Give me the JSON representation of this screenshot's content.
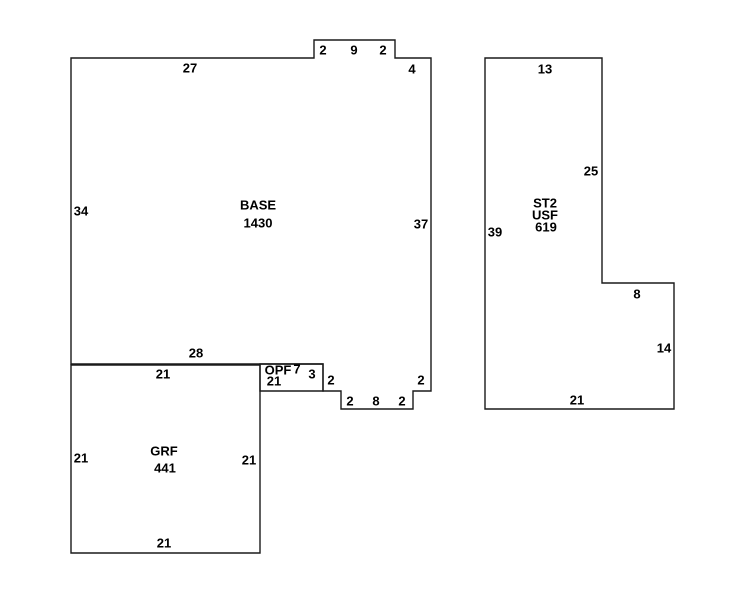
{
  "sketch": {
    "background_color": "#ffffff",
    "line_color": "#1a1a1a",
    "text_color": "#000000",
    "shapes": [
      {
        "name": "base",
        "type_label": "BASE",
        "area_label": "1430",
        "points": [
          [
            71,
            58
          ],
          [
            314,
            58
          ],
          [
            314,
            40
          ],
          [
            395,
            40
          ],
          [
            395,
            58
          ],
          [
            431,
            58
          ],
          [
            431,
            391
          ],
          [
            413,
            391
          ],
          [
            413,
            409
          ],
          [
            341,
            409
          ],
          [
            341,
            391
          ],
          [
            323,
            391
          ],
          [
            323,
            364
          ],
          [
            71,
            364
          ]
        ]
      },
      {
        "name": "opf",
        "type_label": "OPF",
        "area_label": "21",
        "points": [
          [
            260,
            364
          ],
          [
            323,
            364
          ],
          [
            323,
            391
          ],
          [
            260,
            391
          ]
        ]
      },
      {
        "name": "grf",
        "type_label": "GRF",
        "area_label": "441",
        "points": [
          [
            71,
            365
          ],
          [
            260,
            365
          ],
          [
            260,
            553
          ],
          [
            71,
            553
          ]
        ]
      },
      {
        "name": "st2",
        "type_label": "ST2",
        "sub_label": "USF",
        "area_label": "619",
        "points": [
          [
            485,
            58
          ],
          [
            602,
            58
          ],
          [
            602,
            283
          ],
          [
            674,
            283
          ],
          [
            674,
            409
          ],
          [
            485,
            409
          ]
        ]
      }
    ],
    "texts": [
      {
        "t": "27",
        "x": 190,
        "y": 68,
        "kind": "dim",
        "shape": "base"
      },
      {
        "t": "2",
        "x": 323,
        "y": 50,
        "kind": "dim",
        "shape": "base"
      },
      {
        "t": "9",
        "x": 354,
        "y": 50,
        "kind": "dim",
        "shape": "base"
      },
      {
        "t": "2",
        "x": 383,
        "y": 50,
        "kind": "dim",
        "shape": "base"
      },
      {
        "t": "4",
        "x": 412,
        "y": 69,
        "kind": "dim",
        "shape": "base"
      },
      {
        "t": "34",
        "x": 81,
        "y": 211,
        "kind": "dim",
        "shape": "base"
      },
      {
        "t": "BASE",
        "x": 258,
        "y": 205,
        "kind": "type",
        "shape": "base"
      },
      {
        "t": "1430",
        "x": 258,
        "y": 223,
        "kind": "area",
        "shape": "base"
      },
      {
        "t": "37",
        "x": 421,
        "y": 224,
        "kind": "dim",
        "shape": "base"
      },
      {
        "t": "28",
        "x": 196,
        "y": 353,
        "kind": "dim",
        "shape": "base"
      },
      {
        "t": "2",
        "x": 421,
        "y": 380,
        "kind": "dim",
        "shape": "base"
      },
      {
        "t": "2",
        "x": 402,
        "y": 401,
        "kind": "dim",
        "shape": "base"
      },
      {
        "t": "8",
        "x": 376,
        "y": 401,
        "kind": "dim",
        "shape": "base"
      },
      {
        "t": "2",
        "x": 350,
        "y": 401,
        "kind": "dim",
        "shape": "base"
      },
      {
        "t": "2",
        "x": 331,
        "y": 380,
        "kind": "dim",
        "shape": "base"
      },
      {
        "t": "OPF",
        "x": 278,
        "y": 370,
        "kind": "type",
        "shape": "opf"
      },
      {
        "t": "7",
        "x": 297,
        "y": 369,
        "kind": "dim",
        "shape": "opf"
      },
      {
        "t": "21",
        "x": 274,
        "y": 381,
        "kind": "area",
        "shape": "opf"
      },
      {
        "t": "3",
        "x": 312,
        "y": 374,
        "kind": "dim",
        "shape": "opf"
      },
      {
        "t": "21",
        "x": 163,
        "y": 374,
        "kind": "dim",
        "shape": "grf"
      },
      {
        "t": "21",
        "x": 81,
        "y": 458,
        "kind": "dim",
        "shape": "grf"
      },
      {
        "t": "GRF",
        "x": 164,
        "y": 451,
        "kind": "type",
        "shape": "grf"
      },
      {
        "t": "441",
        "x": 165,
        "y": 468,
        "kind": "area",
        "shape": "grf"
      },
      {
        "t": "21",
        "x": 249,
        "y": 460,
        "kind": "dim",
        "shape": "grf"
      },
      {
        "t": "21",
        "x": 164,
        "y": 543,
        "kind": "dim",
        "shape": "grf"
      },
      {
        "t": "13",
        "x": 545,
        "y": 69,
        "kind": "dim",
        "shape": "st2"
      },
      {
        "t": "25",
        "x": 591,
        "y": 171,
        "kind": "dim",
        "shape": "st2"
      },
      {
        "t": "ST2",
        "x": 545,
        "y": 203,
        "kind": "type",
        "shape": "st2"
      },
      {
        "t": "USF",
        "x": 545,
        "y": 215,
        "kind": "type",
        "shape": "st2"
      },
      {
        "t": "619",
        "x": 546,
        "y": 227,
        "kind": "area",
        "shape": "st2"
      },
      {
        "t": "39",
        "x": 495,
        "y": 232,
        "kind": "dim",
        "shape": "st2"
      },
      {
        "t": "8",
        "x": 637,
        "y": 294,
        "kind": "dim",
        "shape": "st2"
      },
      {
        "t": "14",
        "x": 664,
        "y": 348,
        "kind": "dim",
        "shape": "st2"
      },
      {
        "t": "21",
        "x": 577,
        "y": 400,
        "kind": "dim",
        "shape": "st2"
      }
    ]
  }
}
